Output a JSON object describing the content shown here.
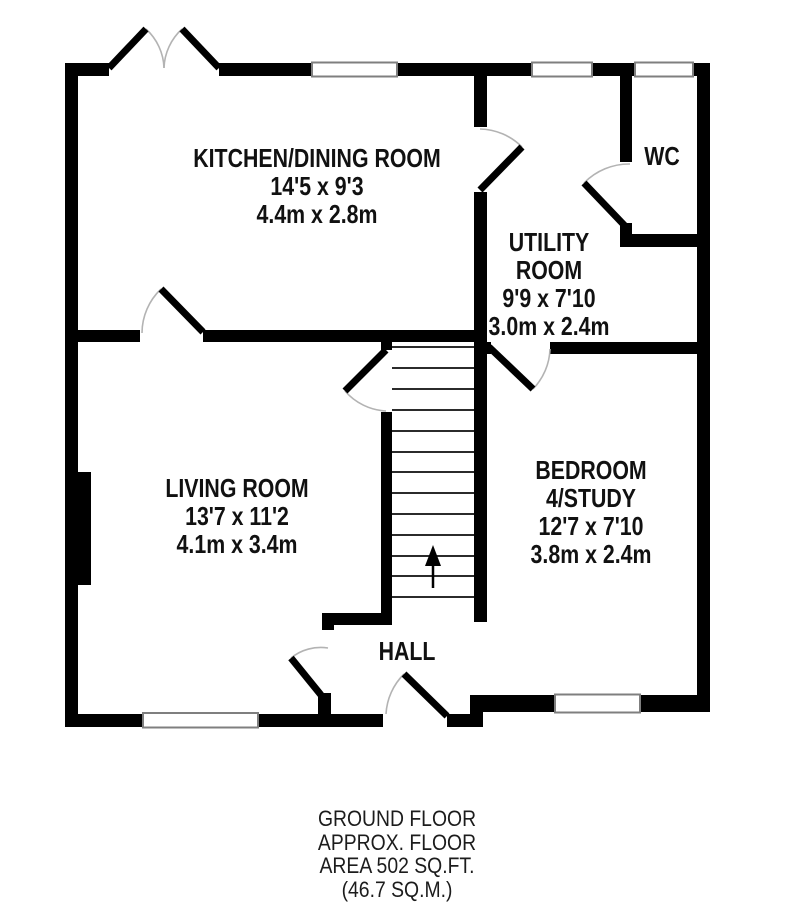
{
  "title": "Ground floor plan",
  "rooms": {
    "kitchen": {
      "lines": [
        "KITCHEN/DINING ROOM",
        "14'5 x 9'3",
        "4.4m x 2.8m"
      ]
    },
    "utility": {
      "lines": [
        "UTILITY",
        "ROOM",
        "9'9 x 7'10",
        "3.0m x 2.4m"
      ]
    },
    "wc": {
      "lines": [
        "WC"
      ]
    },
    "living": {
      "lines": [
        "LIVING ROOM",
        "13'7 x 11'2",
        "4.1m x 3.4m"
      ]
    },
    "bedroom": {
      "lines": [
        "BEDROOM",
        "4/STUDY",
        "12'7 x 7'10",
        "3.8m x 2.4m"
      ]
    },
    "hall": {
      "lines": [
        "HALL"
      ]
    }
  },
  "footer": {
    "lines": [
      "GROUND FLOOR",
      "APPROX. FLOOR",
      "AREA 502 SQ.FT.",
      "(46.7 SQ.M.)"
    ]
  },
  "colors": {
    "wall": "#000000",
    "door_leaf": "#000000",
    "door_arc": "#b3b3b3",
    "window_outline": "#7f7f7f",
    "window_fill": "#ffffff",
    "stair_tread": "#2b2b2b",
    "background": "#ffffff",
    "text": "#111111"
  }
}
